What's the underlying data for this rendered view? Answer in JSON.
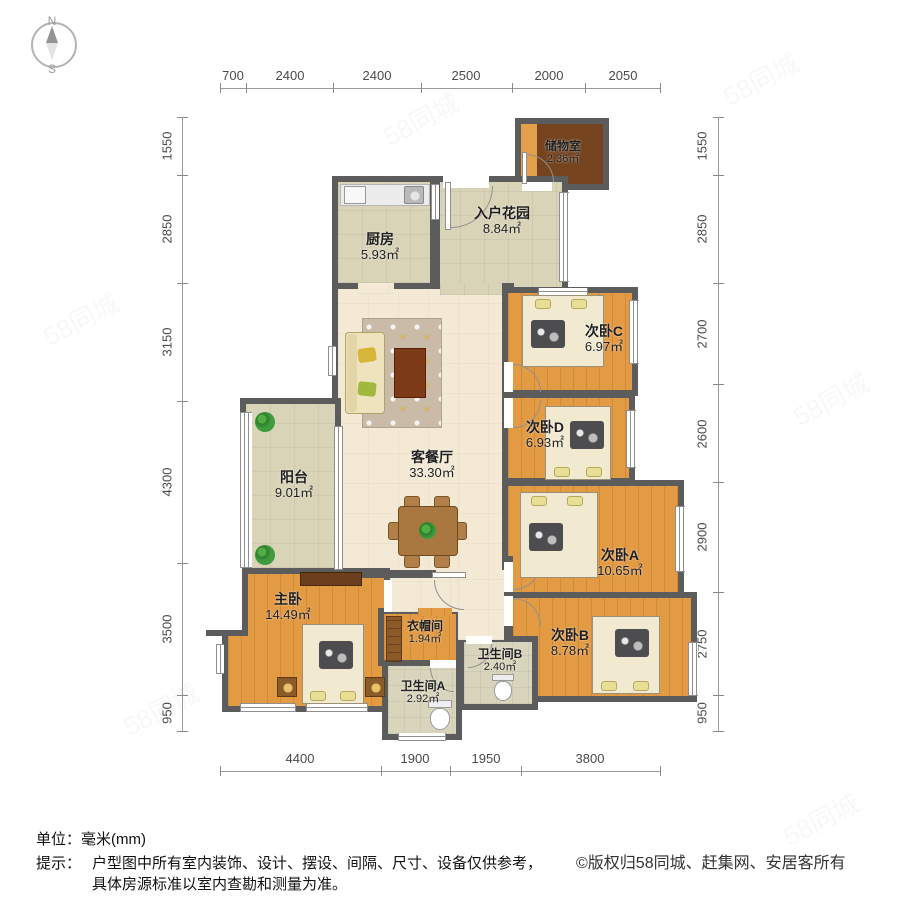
{
  "compass": {
    "north": "N",
    "south": "S"
  },
  "dimensions": {
    "top": [
      "700",
      "2400",
      "2400",
      "2500",
      "2000",
      "2050"
    ],
    "left": [
      "1550",
      "2850",
      "3150",
      "4300",
      "3500",
      "950"
    ],
    "right": [
      "1550",
      "2850",
      "2700",
      "2600",
      "2900",
      "2750",
      "950"
    ],
    "bottom": [
      "4400",
      "1900",
      "1950",
      "3800"
    ]
  },
  "rooms": [
    {
      "id": "storage",
      "name": "储物室",
      "area": "2.36㎡"
    },
    {
      "id": "entry_garden",
      "name": "入户花园",
      "area": "8.84㎡"
    },
    {
      "id": "kitchen",
      "name": "厨房",
      "area": "5.93㎡"
    },
    {
      "id": "living_dining",
      "name": "客餐厅",
      "area": "33.30㎡"
    },
    {
      "id": "balcony",
      "name": "阳台",
      "area": "9.01㎡"
    },
    {
      "id": "bedroom_c",
      "name": "次卧C",
      "area": "6.97㎡"
    },
    {
      "id": "bedroom_d",
      "name": "次卧D",
      "area": "6.93㎡"
    },
    {
      "id": "bedroom_a",
      "name": "次卧A",
      "area": "10.65㎡"
    },
    {
      "id": "bedroom_b",
      "name": "次卧B",
      "area": "8.78㎡"
    },
    {
      "id": "master",
      "name": "主卧",
      "area": "14.49㎡"
    },
    {
      "id": "closet",
      "name": "衣帽间",
      "area": "1.94㎡"
    },
    {
      "id": "bath_b",
      "name": "卫生间B",
      "area": "2.40㎡"
    },
    {
      "id": "bath_a",
      "name": "卫生间A",
      "area": "2.92㎡"
    }
  ],
  "footer": {
    "unit": "单位：毫米(mm)",
    "tip_label": "提示：",
    "tip_line1": "户型图中所有室内装饰、设计、摆设、间隔、尺寸、设备仅供参考，",
    "tip_line2": "具体房源标准以室内查勘和测量为准。",
    "copyright": "©版权归58同城、赶集网、安居客所有"
  },
  "watermark": {
    "text": "58同城"
  }
}
